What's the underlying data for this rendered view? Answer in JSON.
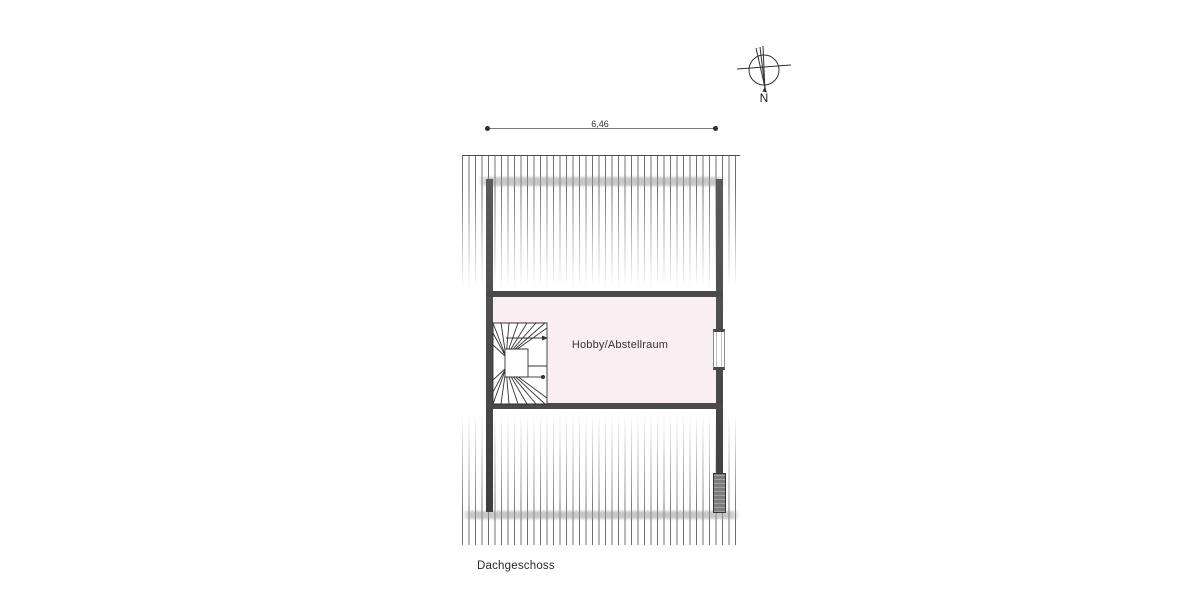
{
  "drawing": {
    "floor_label": "Dachgeschoss",
    "room_label": "Hobby/Abstellraum",
    "dimension_width": "6,46",
    "compass_label": "N"
  },
  "colors": {
    "wall": "#4a4a4a",
    "roomfill": "#f9eef1",
    "stripe": "#707070",
    "band": "#9a9a9a",
    "ink": "#333333"
  }
}
